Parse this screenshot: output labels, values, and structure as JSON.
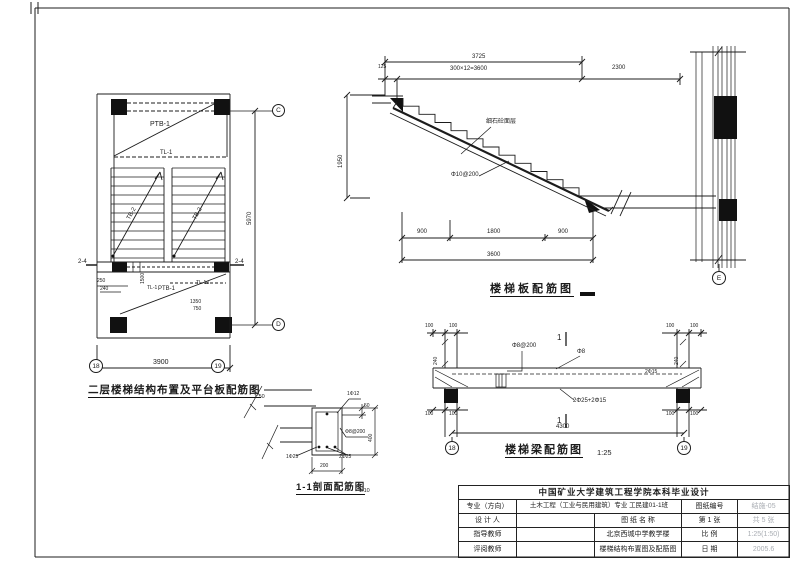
{
  "colors": {
    "ink": "#1c1c1c",
    "gray_text": "#a9adb3",
    "paper": "#ffffff"
  },
  "plan": {
    "caption": "二层楼梯结构布置及平台板配筋图",
    "scale": "1:50",
    "slab_top": "PTB-1",
    "beam_top": "TL-1",
    "flight_left": "TB-2",
    "flight_right": "TB-2",
    "cut_left": "2-4",
    "cut_right": "2-4",
    "beam_mid": "TL-1",
    "dim_1500": "1500",
    "slab_bottom": "PTB-1",
    "beam_bottom": "TL-1a",
    "dim_250": "250",
    "dim_240": "240",
    "dim_1350": "1350",
    "dim_750": "750",
    "dim_width": "3900",
    "dim_height": "5970",
    "bubble_left": "18",
    "bubble_right": "19",
    "bubble_top": "C",
    "bubble_bottom": "D"
  },
  "section": {
    "caption": "楼梯板配筋图",
    "dim_total": "3725",
    "dim_left": "125",
    "dim_steps": "300×12=3600",
    "dim_right": "2300",
    "dim_height": "1950",
    "note_finish": "细石砼面层",
    "note_rebar": "Φ10@200",
    "dim_b1": "900",
    "dim_b2": "1800",
    "dim_b3": "900",
    "dim_b_total": "3600"
  },
  "wall": {
    "bubble": "E"
  },
  "beam": {
    "caption": "楼梯梁配筋图",
    "scale": "1:25",
    "dim_100": "100",
    "dim_240": "240",
    "stirrup": "Φ8@200",
    "cut_mark": "1",
    "bar_top": "Φ8",
    "bar_haunch": "2Φ15",
    "bar_bottom": "2Φ25+2Φ15",
    "dim_span": "4300",
    "bubble_left": "18",
    "bubble_right": "19"
  },
  "detail": {
    "caption": "1-1剖面配筋图",
    "scale": "1:10",
    "bar_top": "1Φ12",
    "dim_50": "50",
    "dim_400": "400",
    "stirrup": "Φ8@200",
    "bar_bl": "1Φ25",
    "bar_br": "2Φ25",
    "dim_200": "200"
  },
  "titleblock": {
    "university": "中国矿业大学建筑工程学院本科毕业设计",
    "major_label": "专业（方向）",
    "major_value": "土木工程（工业与民用建筑）专业 工民建01-1班",
    "sheet_no_label": "图纸编号",
    "sheet_no_value": "结施-05",
    "designer_label": "设 计 人",
    "name_header": "图 纸 名 称",
    "page_label": "第 1 张",
    "pages_value": "共 5 张",
    "advisor_label": "指导教师",
    "project_name": "北京西城中学教学楼",
    "scale_label": "比 例",
    "scale_value": "1:25(1:50)",
    "reviewer_label": "评阅教师",
    "drawing_name": "楼梯结构布置图及配筋图",
    "date_label": "日 期",
    "date_value": "2005.6"
  }
}
